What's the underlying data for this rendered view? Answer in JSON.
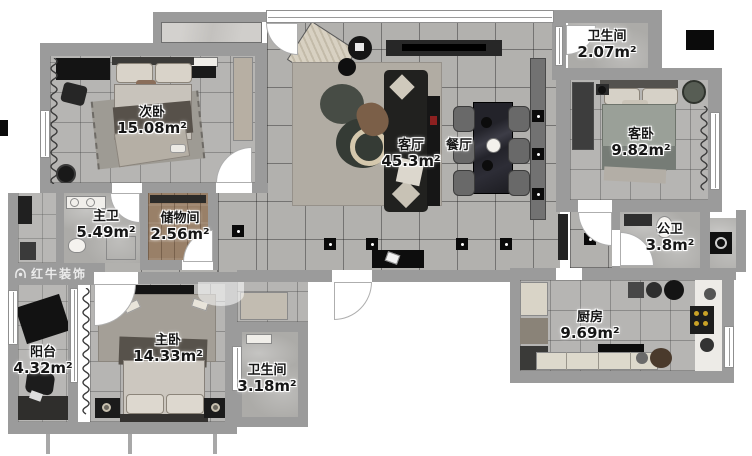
{
  "watermark": {
    "brand": "红牛装饰"
  },
  "rooms": {
    "ciwo": {
      "name": "次卧",
      "area": "15.08m²"
    },
    "zhuwei": {
      "name": "主卫",
      "area": "5.49m²"
    },
    "chuwujian": {
      "name": "储物间",
      "area": "2.56m²"
    },
    "yangtai": {
      "name": "阳台",
      "area": "4.32m²"
    },
    "zhuwo": {
      "name": "主卧",
      "area": "14.33m²"
    },
    "wsj_south": {
      "name": "卫生间",
      "area": "3.18m²"
    },
    "keting": {
      "name": "客厅",
      "area": "45.3m²"
    },
    "canting": {
      "name": "餐厅"
    },
    "wsj_north": {
      "name": "卫生间",
      "area": "2.07m²"
    },
    "kewo": {
      "name": "客卧",
      "area": "9.82m²"
    },
    "gongwei": {
      "name": "公卫",
      "area": "3.8m²"
    },
    "chufang": {
      "name": "厨房",
      "area": "9.69m²"
    }
  }
}
